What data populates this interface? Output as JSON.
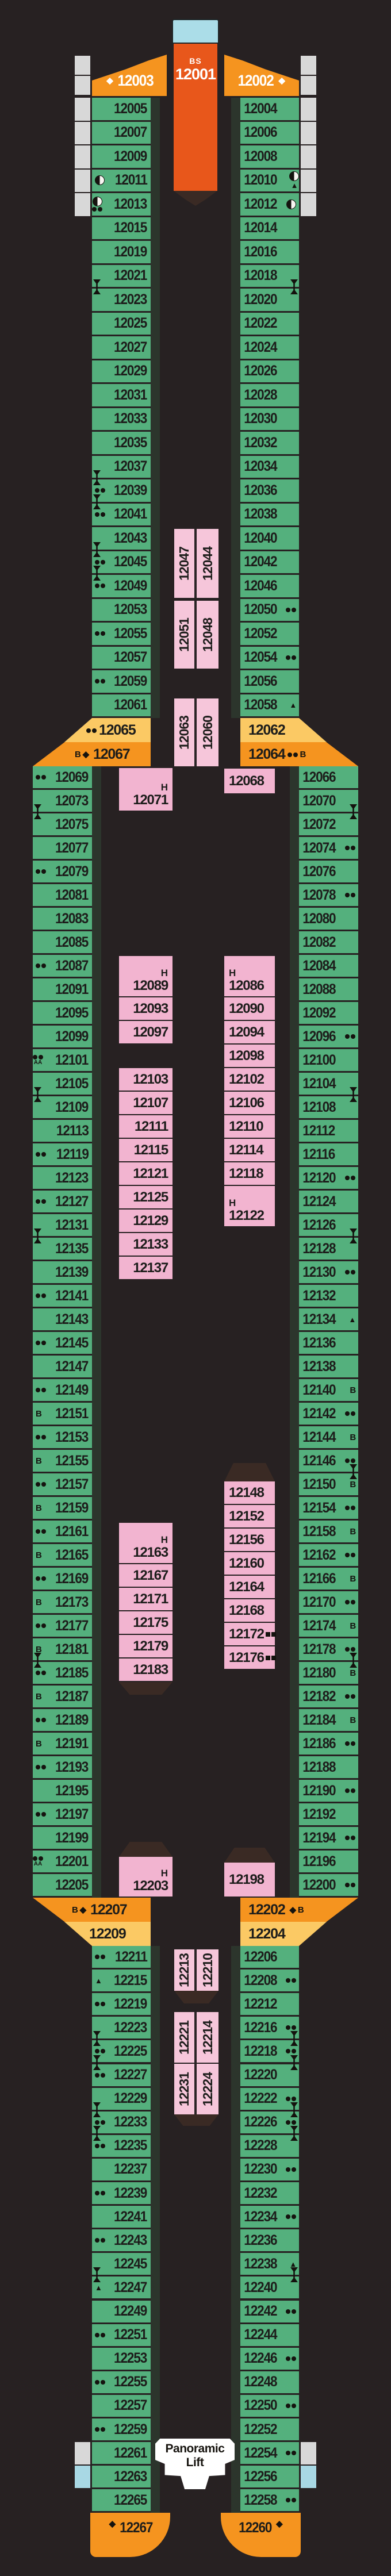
{
  "deck_name": "Deck 12 plan",
  "colors": {
    "background": "#272122",
    "green_cabin": "#54b07d",
    "pink_inner": "#f2b4d0",
    "pink_pair": "#f6c6da",
    "orange_feature": "#f5941f",
    "orange_suite": "#e8571b",
    "yellow_cabin": "#fbc964",
    "cap_blue": "#abdde8",
    "grey_balcony": "#d8d8d8",
    "blue_balcony": "#a8d8e4",
    "dark_shape": "#3a2a24",
    "number_text": "#1d1d1b",
    "white_text": "#ffffff"
  },
  "center_top": {
    "cabin_code": "BS",
    "cabin_number": "12001"
  },
  "lift": {
    "line1": "Panoramic",
    "line2": "Lift"
  },
  "top_port_feature": {
    "n": "12003",
    "icons": [
      "diamond"
    ]
  },
  "top_stbd_feature": {
    "n": "12002",
    "icons": [
      "diamond"
    ]
  },
  "aft_port_feature": {
    "n": "12267",
    "icons": [
      "diamond"
    ]
  },
  "aft_stbd_feature": {
    "n": "12260",
    "icons": [
      "diamond"
    ]
  },
  "bands_fwd": {
    "port_yellow": {
      "n": "12065",
      "icons": [
        "dots"
      ]
    },
    "port_orange": {
      "n": "12067",
      "icons": [
        "B",
        "diamond",
        "square"
      ]
    },
    "stbd_yellow": {
      "n": "12062",
      "icons": []
    },
    "stbd_orange": {
      "n": "12064",
      "icons": [
        "dots",
        "B"
      ]
    }
  },
  "bands_aft": {
    "port_orange": {
      "n": "12207",
      "icons": [
        "B",
        "diamond",
        "square"
      ]
    },
    "port_yellow": {
      "n": "12209",
      "icons": []
    },
    "stbd_orange": {
      "n": "12202",
      "icons": [
        "square",
        "diamond",
        "B"
      ]
    },
    "stbd_yellow": {
      "n": "12204",
      "icons": []
    }
  },
  "top_port": {
    "rows": [
      {
        "n": "12005"
      },
      {
        "n": "12007"
      },
      {
        "n": "12009"
      },
      {
        "n": "12011",
        "icons": [
          "moon"
        ]
      },
      {
        "n": "12013",
        "icons": [
          "moon",
          "dots"
        ],
        "stack": true
      },
      {
        "n": "12015"
      },
      {
        "n": "12019"
      },
      {
        "n": "12021",
        "div": true
      },
      {
        "n": "12023"
      },
      {
        "n": "12025"
      },
      {
        "n": "12027"
      },
      {
        "n": "12029"
      },
      {
        "n": "12031"
      },
      {
        "n": "12033"
      },
      {
        "n": "12035"
      },
      {
        "n": "12037",
        "div": true
      },
      {
        "n": "12039",
        "icons": [
          "dots"
        ],
        "div": true
      },
      {
        "n": "12041",
        "icons": [
          "dots"
        ]
      },
      {
        "n": "12043",
        "div": true
      },
      {
        "n": "12045",
        "icons": [
          "dots"
        ],
        "div": true
      },
      {
        "n": "12049",
        "icons": [
          "dots"
        ]
      },
      {
        "n": "12053"
      },
      {
        "n": "12055",
        "icons": [
          "dots"
        ]
      },
      {
        "n": "12057"
      },
      {
        "n": "12059",
        "icons": [
          "dots"
        ]
      },
      {
        "n": "12061"
      }
    ]
  },
  "top_stbd": {
    "rows": [
      {
        "n": "12004"
      },
      {
        "n": "12006"
      },
      {
        "n": "12008"
      },
      {
        "n": "12010",
        "icons": [
          "moon",
          "triangle"
        ],
        "stack": true
      },
      {
        "n": "12012",
        "icons": [
          "moon"
        ]
      },
      {
        "n": "12014"
      },
      {
        "n": "12016"
      },
      {
        "n": "12018",
        "div": true
      },
      {
        "n": "12020"
      },
      {
        "n": "12022"
      },
      {
        "n": "12024"
      },
      {
        "n": "12026"
      },
      {
        "n": "12028"
      },
      {
        "n": "12030"
      },
      {
        "n": "12032"
      },
      {
        "n": "12034"
      },
      {
        "n": "12036"
      },
      {
        "n": "12038"
      },
      {
        "n": "12040"
      },
      {
        "n": "12042"
      },
      {
        "n": "12046"
      },
      {
        "n": "12050",
        "icons": [
          "dots"
        ]
      },
      {
        "n": "12052"
      },
      {
        "n": "12054",
        "icons": [
          "dots"
        ]
      },
      {
        "n": "12056"
      },
      {
        "n": "12058",
        "icons": [
          "triangle"
        ]
      }
    ]
  },
  "mid_port": {
    "rows": [
      {
        "n": "12069",
        "icons": [
          "dots"
        ]
      },
      {
        "n": "12073",
        "div": true
      },
      {
        "n": "12075"
      },
      {
        "n": "12077"
      },
      {
        "n": "12079",
        "icons": [
          "dots"
        ]
      },
      {
        "n": "12081"
      },
      {
        "n": "12083"
      },
      {
        "n": "12085"
      },
      {
        "n": "12087",
        "icons": [
          "dots"
        ]
      },
      {
        "n": "12091"
      },
      {
        "n": "12095"
      },
      {
        "n": "12099"
      },
      {
        "n": "12101",
        "icons": [
          "dots",
          "AA"
        ],
        "stack": true
      },
      {
        "n": "12105",
        "div": true
      },
      {
        "n": "12109"
      },
      {
        "n": "12113"
      },
      {
        "n": "12119",
        "icons": [
          "dots"
        ]
      },
      {
        "n": "12123"
      },
      {
        "n": "12127",
        "icons": [
          "dots"
        ]
      },
      {
        "n": "12131",
        "div": true
      },
      {
        "n": "12135"
      },
      {
        "n": "12139"
      },
      {
        "n": "12141",
        "icons": [
          "dots"
        ]
      },
      {
        "n": "12143"
      },
      {
        "n": "12145",
        "icons": [
          "dots"
        ]
      },
      {
        "n": "12147"
      },
      {
        "n": "12149",
        "icons": [
          "dots"
        ]
      },
      {
        "n": "12151",
        "icons": [
          "B"
        ]
      },
      {
        "n": "12153",
        "icons": [
          "dots"
        ]
      },
      {
        "n": "12155",
        "icons": [
          "B"
        ]
      },
      {
        "n": "12157",
        "icons": [
          "dots"
        ]
      },
      {
        "n": "12159",
        "icons": [
          "B"
        ]
      },
      {
        "n": "12161",
        "icons": [
          "dots"
        ]
      },
      {
        "n": "12165",
        "icons": [
          "B"
        ]
      },
      {
        "n": "12169",
        "icons": [
          "dots"
        ]
      },
      {
        "n": "12173",
        "icons": [
          "B"
        ]
      },
      {
        "n": "12177",
        "icons": [
          "dots"
        ]
      },
      {
        "n": "12181",
        "icons": [
          "B"
        ],
        "div": true
      },
      {
        "n": "12185",
        "icons": [
          "dots"
        ]
      },
      {
        "n": "12187",
        "icons": [
          "B"
        ]
      },
      {
        "n": "12189",
        "icons": [
          "dots"
        ]
      },
      {
        "n": "12191",
        "icons": [
          "B"
        ]
      },
      {
        "n": "12193",
        "icons": [
          "dots"
        ]
      },
      {
        "n": "12195"
      },
      {
        "n": "12197",
        "icons": [
          "dots"
        ]
      },
      {
        "n": "12199"
      },
      {
        "n": "12201",
        "icons": [
          "dots",
          "AA"
        ],
        "stack": true
      },
      {
        "n": "12205"
      }
    ]
  },
  "mid_stbd": {
    "rows": [
      {
        "n": "12066"
      },
      {
        "n": "12070",
        "div": true
      },
      {
        "n": "12072"
      },
      {
        "n": "12074",
        "icons": [
          "dots"
        ]
      },
      {
        "n": "12076"
      },
      {
        "n": "12078",
        "icons": [
          "dots"
        ]
      },
      {
        "n": "12080"
      },
      {
        "n": "12082"
      },
      {
        "n": "12084"
      },
      {
        "n": "12088"
      },
      {
        "n": "12092"
      },
      {
        "n": "12096",
        "icons": [
          "dots"
        ]
      },
      {
        "n": "12100"
      },
      {
        "n": "12104",
        "div": true
      },
      {
        "n": "12108"
      },
      {
        "n": "12112"
      },
      {
        "n": "12116"
      },
      {
        "n": "12120",
        "icons": [
          "dots"
        ]
      },
      {
        "n": "12124"
      },
      {
        "n": "12126",
        "div": true
      },
      {
        "n": "12128"
      },
      {
        "n": "12130",
        "icons": [
          "dots"
        ]
      },
      {
        "n": "12132"
      },
      {
        "n": "12134",
        "icons": [
          "triangle"
        ]
      },
      {
        "n": "12136"
      },
      {
        "n": "12138"
      },
      {
        "n": "12140",
        "icons": [
          "B"
        ]
      },
      {
        "n": "12142",
        "icons": [
          "dots"
        ]
      },
      {
        "n": "12144",
        "icons": [
          "B"
        ]
      },
      {
        "n": "12146",
        "icons": [
          "dots"
        ],
        "div": true
      },
      {
        "n": "12150",
        "icons": [
          "B"
        ]
      },
      {
        "n": "12154",
        "icons": [
          "dots"
        ]
      },
      {
        "n": "12158",
        "icons": [
          "B"
        ]
      },
      {
        "n": "12162",
        "icons": [
          "dots"
        ]
      },
      {
        "n": "12166",
        "icons": [
          "B"
        ]
      },
      {
        "n": "12170",
        "icons": [
          "dots"
        ]
      },
      {
        "n": "12174",
        "icons": [
          "B"
        ]
      },
      {
        "n": "12178",
        "icons": [
          "dots"
        ],
        "div": true
      },
      {
        "n": "12180",
        "icons": [
          "B"
        ]
      },
      {
        "n": "12182",
        "icons": [
          "dots"
        ]
      },
      {
        "n": "12184",
        "icons": [
          "B"
        ]
      },
      {
        "n": "12186",
        "icons": [
          "dots"
        ]
      },
      {
        "n": "12188"
      },
      {
        "n": "12190",
        "icons": [
          "dots"
        ]
      },
      {
        "n": "12192"
      },
      {
        "n": "12194",
        "icons": [
          "dots"
        ]
      },
      {
        "n": "12196"
      },
      {
        "n": "12200",
        "icons": [
          "dots"
        ]
      }
    ]
  },
  "aft_port": {
    "rows": [
      {
        "n": "12211",
        "icons": [
          "dots"
        ]
      },
      {
        "n": "12215",
        "icons": [
          "triangle"
        ]
      },
      {
        "n": "12219",
        "icons": [
          "dots"
        ]
      },
      {
        "n": "12223",
        "div": true
      },
      {
        "n": "12225",
        "icons": [
          "dots"
        ],
        "div": true
      },
      {
        "n": "12227",
        "icons": [
          "dots"
        ]
      },
      {
        "n": "12229",
        "div": true
      },
      {
        "n": "12233",
        "icons": [
          "dots"
        ],
        "div": true
      },
      {
        "n": "12235",
        "icons": [
          "dots"
        ]
      },
      {
        "n": "12237"
      },
      {
        "n": "12239",
        "icons": [
          "dots"
        ]
      },
      {
        "n": "12241"
      },
      {
        "n": "12243",
        "icons": [
          "dots"
        ]
      },
      {
        "n": "12245",
        "div": true
      },
      {
        "n": "12247",
        "icons": [
          "triangle"
        ]
      },
      {
        "n": "12249"
      },
      {
        "n": "12251",
        "icons": [
          "dots"
        ]
      },
      {
        "n": "12253"
      },
      {
        "n": "12255",
        "icons": [
          "dots"
        ]
      },
      {
        "n": "12257"
      },
      {
        "n": "12259",
        "icons": [
          "dots"
        ]
      },
      {
        "n": "12261"
      },
      {
        "n": "12263"
      },
      {
        "n": "12265"
      }
    ]
  },
  "aft_stbd": {
    "rows": [
      {
        "n": "12206"
      },
      {
        "n": "12208",
        "icons": [
          "dots"
        ]
      },
      {
        "n": "12212"
      },
      {
        "n": "12216",
        "icons": [
          "dots"
        ],
        "div": true
      },
      {
        "n": "12218",
        "icons": [
          "dots"
        ],
        "div": true
      },
      {
        "n": "12220"
      },
      {
        "n": "12222",
        "icons": [
          "dots"
        ],
        "div": true
      },
      {
        "n": "12226",
        "icons": [
          "dots"
        ],
        "div": true
      },
      {
        "n": "12228"
      },
      {
        "n": "12230",
        "icons": [
          "dots"
        ]
      },
      {
        "n": "12232"
      },
      {
        "n": "12234",
        "icons": [
          "dots"
        ]
      },
      {
        "n": "12236"
      },
      {
        "n": "12238",
        "icons": [
          "triangle"
        ],
        "div": true
      },
      {
        "n": "12240"
      },
      {
        "n": "12242",
        "icons": [
          "dots"
        ]
      },
      {
        "n": "12244"
      },
      {
        "n": "12246",
        "icons": [
          "dots"
        ]
      },
      {
        "n": "12248"
      },
      {
        "n": "12250",
        "icons": [
          "dots"
        ]
      },
      {
        "n": "12252"
      },
      {
        "n": "12254",
        "icons": [
          "dots"
        ]
      },
      {
        "n": "12256"
      },
      {
        "n": "12258",
        "icons": [
          "dots"
        ]
      }
    ]
  },
  "inner_port": {
    "fwd_single": {
      "n": "12071",
      "h": true
    },
    "block1": [
      {
        "n": "12089",
        "h": true
      },
      {
        "n": "12093"
      },
      {
        "n": "12097"
      },
      {
        "n": "12103"
      },
      {
        "n": "12107"
      },
      {
        "n": "12111"
      },
      {
        "n": "12115"
      },
      {
        "n": "12121"
      },
      {
        "n": "12125"
      },
      {
        "n": "12129"
      },
      {
        "n": "12133"
      },
      {
        "n": "12137"
      }
    ],
    "block2": [
      {
        "n": "12163",
        "h": true
      },
      {
        "n": "12167"
      },
      {
        "n": "12171"
      },
      {
        "n": "12175"
      },
      {
        "n": "12179"
      },
      {
        "n": "12183"
      }
    ],
    "aft_single": {
      "n": "12203",
      "h": true
    }
  },
  "inner_stbd": {
    "fwd_single": {
      "n": "12068"
    },
    "block1": [
      {
        "n": "12086",
        "h": true
      },
      {
        "n": "12090"
      },
      {
        "n": "12094"
      },
      {
        "n": "12098"
      },
      {
        "n": "12102"
      },
      {
        "n": "12106"
      },
      {
        "n": "12110"
      },
      {
        "n": "12114"
      },
      {
        "n": "12118"
      },
      {
        "n": "12122",
        "h": true
      }
    ],
    "block2": [
      {
        "n": "12148"
      },
      {
        "n": "12152"
      },
      {
        "n": "12156"
      },
      {
        "n": "12160"
      },
      {
        "n": "12164"
      },
      {
        "n": "12168"
      },
      {
        "n": "12172",
        "icons": [
          "squares"
        ]
      },
      {
        "n": "12176",
        "icons": [
          "squares"
        ]
      }
    ],
    "aft_single": {
      "n": "12198"
    }
  },
  "center_pairs": [
    {
      "left": "12047",
      "right": "12044"
    },
    {
      "left": "12051",
      "right": "12048"
    },
    {
      "left": "12063",
      "right": "12060"
    },
    {
      "left": "12213",
      "right": "12210"
    },
    {
      "left": "12221",
      "right": "12214"
    },
    {
      "left": "12231",
      "right": "12224"
    }
  ]
}
